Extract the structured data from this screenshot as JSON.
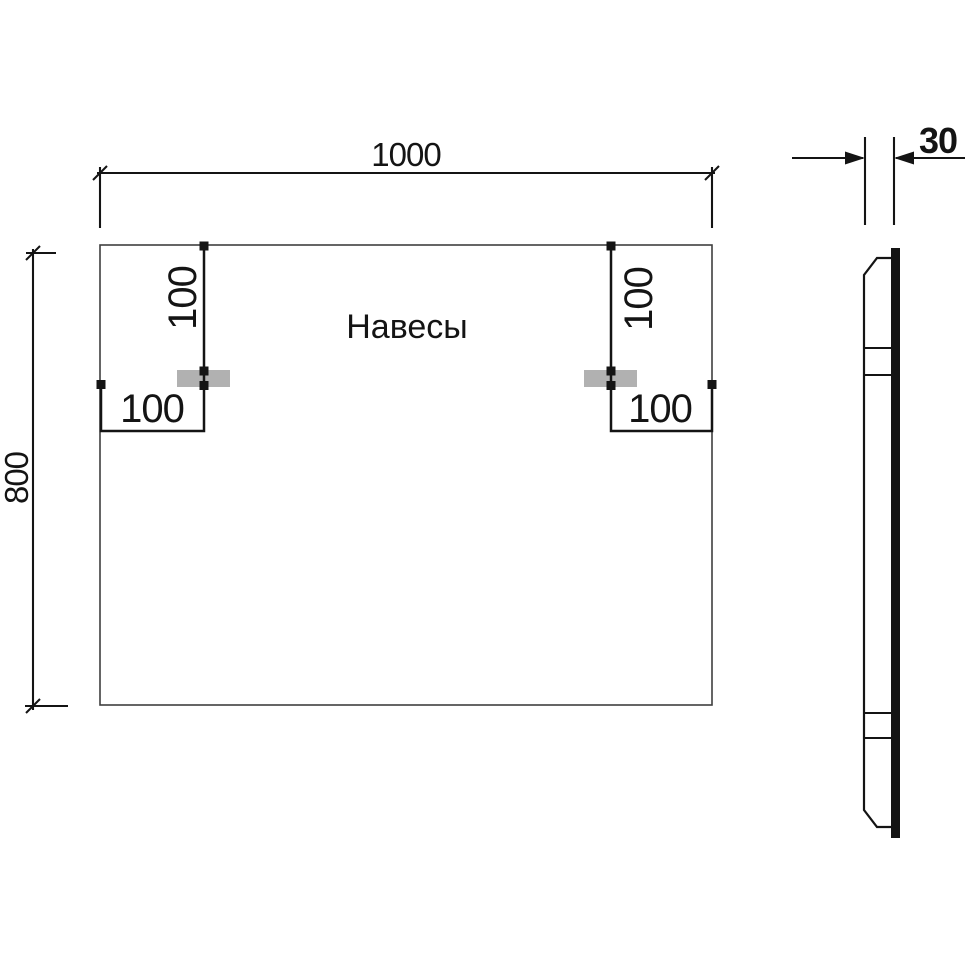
{
  "front_view": {
    "label": "Навесы",
    "width_mm": "1000",
    "height_mm": "800",
    "left_bracket": {
      "drop_mm": "100",
      "inset_mm": "100"
    },
    "right_bracket": {
      "drop_mm": "100",
      "inset_mm": "100"
    }
  },
  "side_view": {
    "thickness_mm": "30"
  },
  "colors": {
    "line": "#141414",
    "outline": "#3f3f3f",
    "bracket_fill": "#b1b1b1",
    "background": "#ffffff"
  }
}
